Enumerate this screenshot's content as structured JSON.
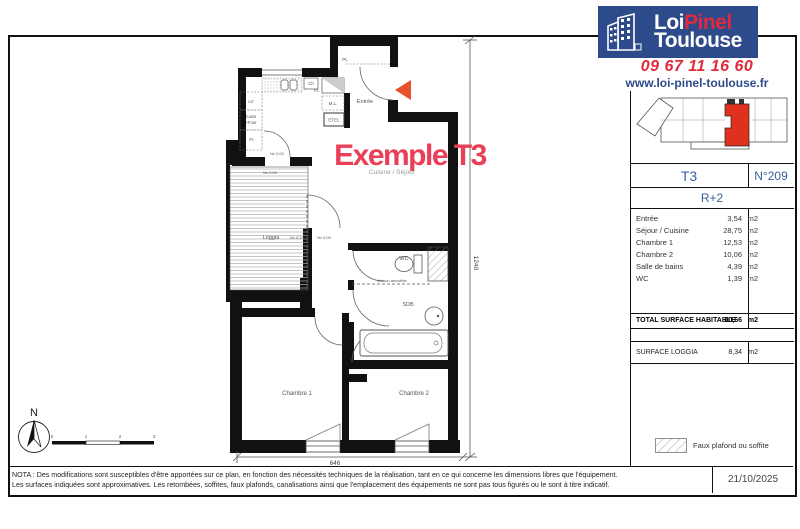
{
  "brand": {
    "name_part1": "Loi",
    "name_part2": "Pinel",
    "name_part3": "Toulouse",
    "phone": "09 67 11 16 60",
    "website": "www.loi-pinel-toulouse.fr"
  },
  "colors": {
    "brand_navy": "#2d4a8a",
    "brand_red": "#e02a3c",
    "title_red": "#e94057",
    "arrow_orange_red": "#e8512b",
    "unit_highlight_red": "#e0301e",
    "table_blue": "#3a5f9e"
  },
  "sidebar": {
    "type_label": "T3",
    "lot_number": "N°209",
    "floor": "R+2",
    "unit": "m2",
    "rooms": [
      {
        "label": "Entrée",
        "area": "3,54"
      },
      {
        "label": "Séjour / Cuisine",
        "area": "28,75"
      },
      {
        "label": "Chambre 1",
        "area": "12,53"
      },
      {
        "label": "Chambre 2",
        "area": "10,06"
      },
      {
        "label": "Salle de bains",
        "area": "4,39"
      },
      {
        "label": "WC",
        "area": "1,39"
      }
    ],
    "total_label": "TOTAL SURFACE HABITABLE",
    "total_area": "60,66",
    "loggia_label": "SURFACE LOGGIA",
    "loggia_area": "8,34",
    "legend_label": "Faux plafond ou soffite"
  },
  "plan": {
    "title": "Exemple T3",
    "subtitle": "Cuisine / Séjour",
    "rooms": {
      "entree": "Entrée",
      "loggia": "Loggia",
      "chambre1": "Chambre 1",
      "chambre2": "Chambre 2",
      "wc": "WC",
      "sdb": "SDB"
    },
    "annotations": {
      "pl_top": "PL",
      "ch": "Ch",
      "pl_small": "PL.",
      "lv": "LV",
      "cuiss": "Cuiss",
      "four": "+Four",
      "fr": "Fr.",
      "ml": "M.L.",
      "etel": "ETEL",
      "cloison": "cloison amovible",
      "nv000": "Nv 0,00",
      "nv010": "Nv 0,10"
    },
    "dimensions": {
      "vertical": "1240",
      "horizontal": "646"
    },
    "compass_north": "N",
    "scale_ticks": [
      "0",
      "1",
      "2",
      "3"
    ]
  },
  "footer": {
    "nota_line1": "NOTA : Des modifications sont susceptibles d'être apportées sur ce plan, en fonction des nécessités techniques de la réalisation, tant en ce qui concerne les dimensions libres que l'équipement.",
    "nota_line2": "Les surfaces indiquées sont approximatives. Les retombées, soffites, faux plafonds, canalisations ainsi que l'emplacement des équipements ne sont pas tous figurés ou le sont à titre indicatif.",
    "date": "21/10/2025"
  }
}
